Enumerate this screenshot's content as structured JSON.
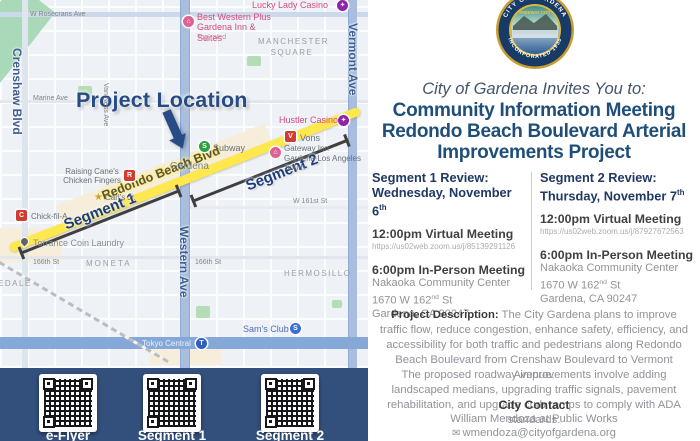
{
  "colors": {
    "accent_navy": "#1F4E79",
    "band_navy": "#33507D",
    "highlight_yellow": "#FFE84D",
    "map_pink": "#D24C82",
    "map_purple": "#8E24AA",
    "street_blue": "#3D5E92"
  },
  "map": {
    "project_location_label": "Project Location",
    "road_label": "Redondo Beach Blvd",
    "segment1_label": "Segment 1",
    "segment2_label": "Segment 2",
    "labels": {
      "rosecrans": "W Rosecrans Ave",
      "marine": "Marine Ave",
      "st166_left": "166th St",
      "st166_mid": "166th St",
      "w161": "W 161st St",
      "crenshaw": "Crenshaw Blvd",
      "vanness": "Van Ness Ave",
      "vermont": "Vermont Ave",
      "western": "Western Ave",
      "manchester": "MANCHESTER SQUARE",
      "moneta": "MONETA",
      "hermosillo": "HERMOSILLO",
      "edale": "EDALE",
      "gardena": "Gardena",
      "lucky": "Lucky Lady Casino",
      "bestwestern": "Best Western Plus Gardena Inn & Suites",
      "toprated": "Top rated",
      "hustler": "Hustler Casino",
      "vons": "Vons",
      "gateway": "Gateway Inn Gardena Los Angeles South",
      "subway": "Subway",
      "canes": "Raising Cane's Chicken Fingers",
      "carlsjr": "Carl's Jr.",
      "chickfila": "Chick-fil-A",
      "laundry": "Torrance Coin Laundry",
      "samsclub": "Sam's Club",
      "tokyo": "Tokyo Central"
    },
    "icon_glyphs": {
      "hotel": "⌂",
      "casino": "✦",
      "vons": "V",
      "subway": "S",
      "canes": "R",
      "chickfila": "C",
      "star": "★",
      "samsclub": "S",
      "tokyo": "T"
    }
  },
  "qr": {
    "items": [
      {
        "label": "e-Flyer"
      },
      {
        "label": "Segment 1"
      },
      {
        "label": "Segment 2"
      }
    ]
  },
  "flyer": {
    "seal": {
      "top_arc": "CITY OF GARDENA",
      "bottom_arc": "INCORPORATED 1930",
      "banner": "FREEWAY CITY"
    },
    "invite_line": "City of Gardena Invites You to:",
    "title_lines": {
      "l1": "Community Information Meeting",
      "l2": "Redondo Beach Boulevard Arterial",
      "l3": "Improvements Project"
    },
    "sessions": [
      {
        "review_label": "Segment 1 Review:",
        "date_main": "Wednesday, November 6",
        "date_sup": "th",
        "virtual_heading": "12:00pm Virtual Meeting",
        "virtual_link": "https://us02web.zoom.us/j/85139291126",
        "inperson_heading": "6:00pm In-Person Meeting",
        "venue": "Nakaoka Community Center",
        "address_main": "1670 W 162",
        "address_sup": "nd",
        "address_tail": " St",
        "city_line": "Gardena, CA 90247"
      },
      {
        "review_label": "Segment 2 Review:",
        "date_main": "Thursday, November 7",
        "date_sup": "th",
        "virtual_heading": "12:00pm Virtual Meeting",
        "virtual_link": "https://us02web.zoom.us/j/87927672563",
        "inperson_heading": "6:00pm In-Person Meeting",
        "venue": "Nakaoka Community Center",
        "address_main": "1670 W 162",
        "address_sup": "nd",
        "address_tail": " St",
        "city_line": "Gardena, CA 90247"
      }
    ],
    "description": {
      "label": "Project Description:",
      "text": " The City Gardena plans to improve traffic flow, reduce congestion, enhance safety, efficiency, and accessibility for both traffic and pedestrians along Redondo Beach Boulevard from Crenshaw Boulevard to Vermont Avenue."
    },
    "description2": "The proposed roadway improvements involve adding landscaped medians, upgrading traffic signals, pavement rehabilitation, and upgrade curb ramps to comply with ADA standards.",
    "contact": {
      "heading": "City Contact",
      "line1": "William Mendoza at Public Works",
      "email_icon": "✉",
      "email": "wmendoza@cityofgardena.org",
      "phone_icon": "✆",
      "phone": "310-217-9608"
    }
  }
}
